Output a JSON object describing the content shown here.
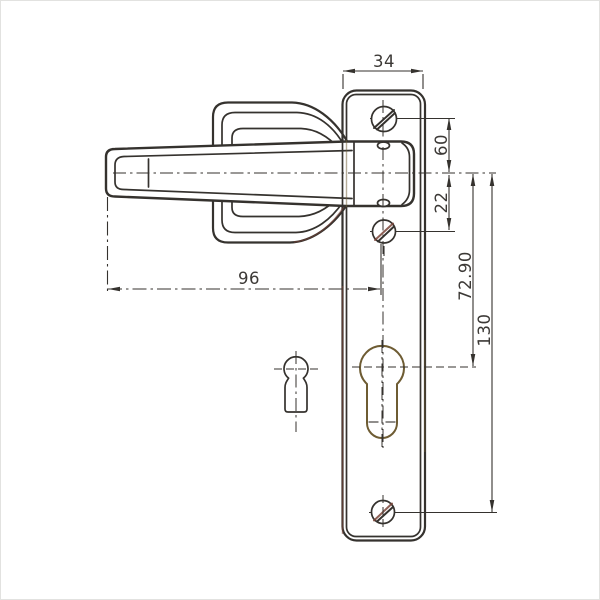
{
  "drawing": {
    "type": "technical dimension drawing",
    "subject": "door lever handle on long backplate with euro-profile cylinder cutout and keyhole profile",
    "colors": {
      "bg": "#ffffff",
      "ink": "#35322e",
      "ink2": "#3c3936",
      "red": "#7a4438",
      "olive": "#6e5c33",
      "frame": "#e2e2e0"
    },
    "dimensions": {
      "plate_width": "34",
      "handle_length": "96",
      "axis_to_top_screw": "60",
      "axis_to_mid_screw": "22",
      "axis_to_cylinder": "72.90",
      "axis_to_bottom_screw": "130"
    }
  }
}
